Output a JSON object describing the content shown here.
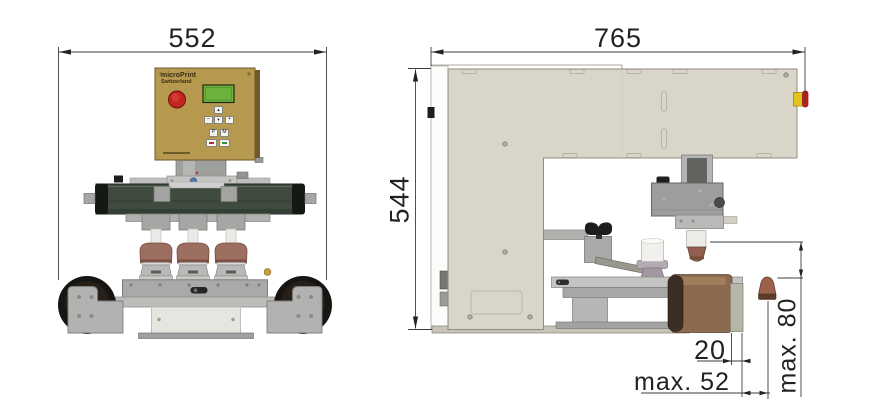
{
  "drawing": {
    "type": "machine dimension drawing, front and side view",
    "front_view": {
      "width_dim": "552",
      "panel": {
        "brand": "microPrint",
        "country": "Switzerland",
        "keys": [
          {
            "name": "up",
            "label": "▲"
          },
          {
            "name": "minus",
            "label": "–"
          },
          {
            "name": "down",
            "label": "▼"
          },
          {
            "name": "plus",
            "label": "+"
          },
          {
            "name": "p",
            "label": "P"
          },
          {
            "name": "m",
            "label": "M"
          },
          {
            "name": "stop",
            "label": ""
          },
          {
            "name": "start",
            "label": ""
          }
        ]
      }
    },
    "side_view": {
      "width_dim": "765",
      "height_dim": "544",
      "offset_dim": "20",
      "max_width_dim": "max. 52",
      "max_height_dim": "max. 80"
    },
    "colors": {
      "panel_gold": "#b6994f",
      "display_green": "#6cb23c",
      "emergency_red": "#c32420",
      "emergency_yellow": "#e6c31c",
      "body_beige": "#d9d6c9",
      "ink_bar_green": "#3f4b3e",
      "pad_brown": "#9d6f60",
      "roller_brown": "#8b6a50",
      "wheel_black": "#171513",
      "dimension_line": "#3c3c3c"
    }
  }
}
